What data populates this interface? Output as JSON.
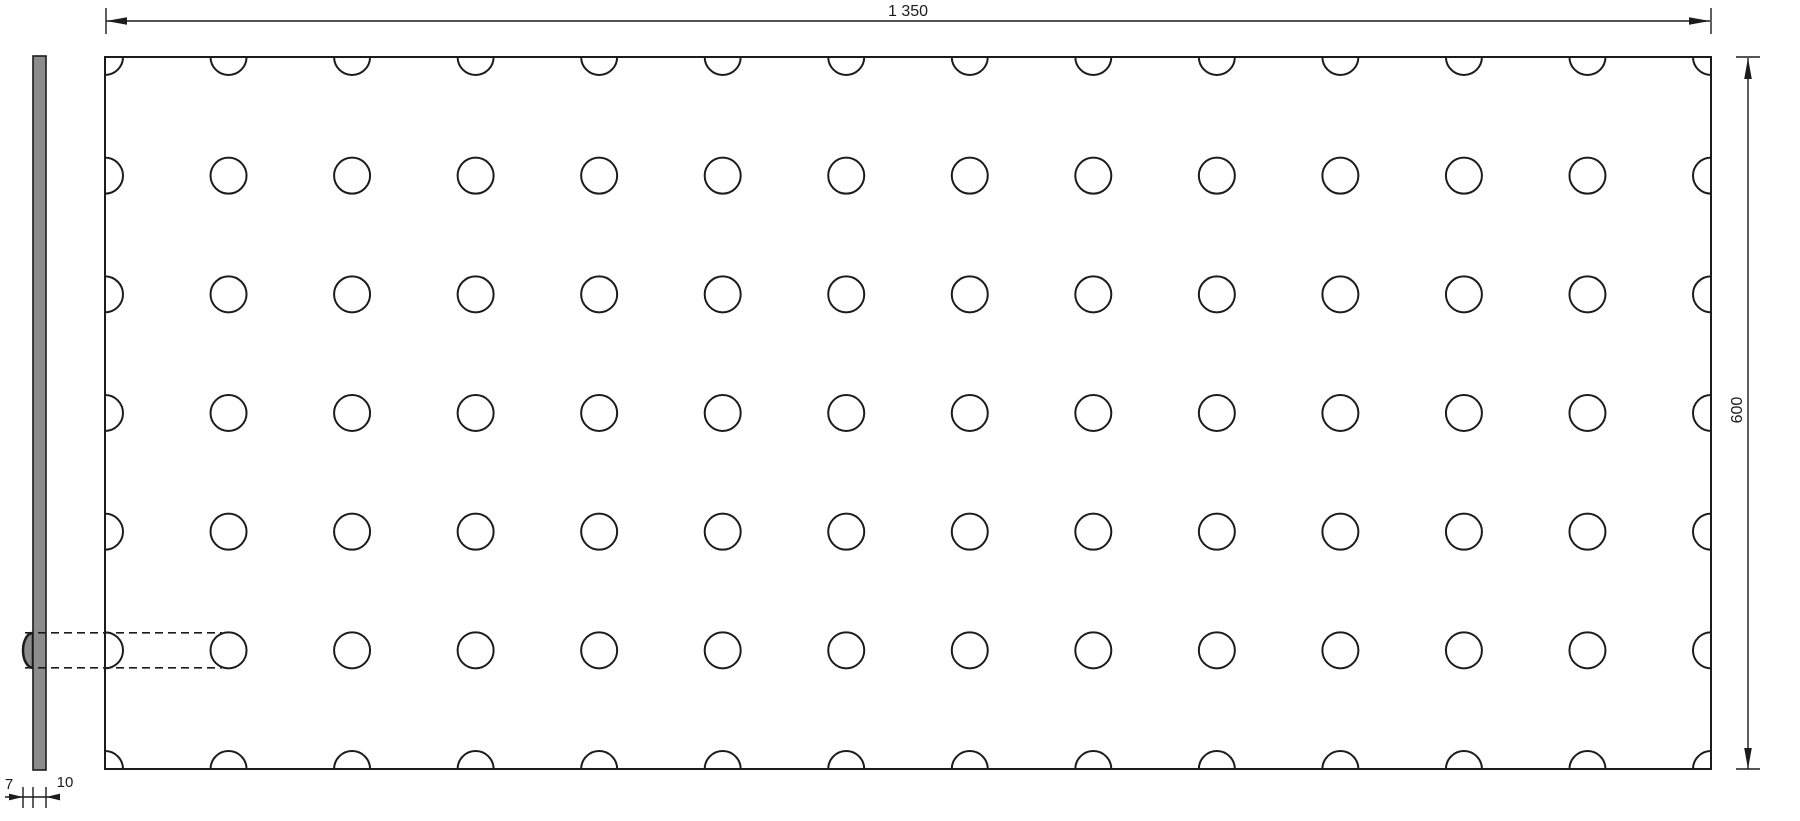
{
  "drawing": {
    "type": "technical_drawing",
    "views": {
      "front": {
        "hole_grid": {
          "columns": 14,
          "rows": 7,
          "edge_centered": true,
          "highlighted_row_index": 6
        }
      },
      "side": {
        "has_emboss_bump": true,
        "bump_row_index": 6
      }
    },
    "dimensions": {
      "width": {
        "label": "1 350"
      },
      "height": {
        "label": "600"
      },
      "emboss_depth": {
        "label": "7"
      },
      "panel_thickness": {
        "label": "10"
      }
    },
    "colors": {
      "line": "#1c1c1c",
      "strip_fill": "#8c8c8c",
      "background": "#ffffff"
    }
  }
}
